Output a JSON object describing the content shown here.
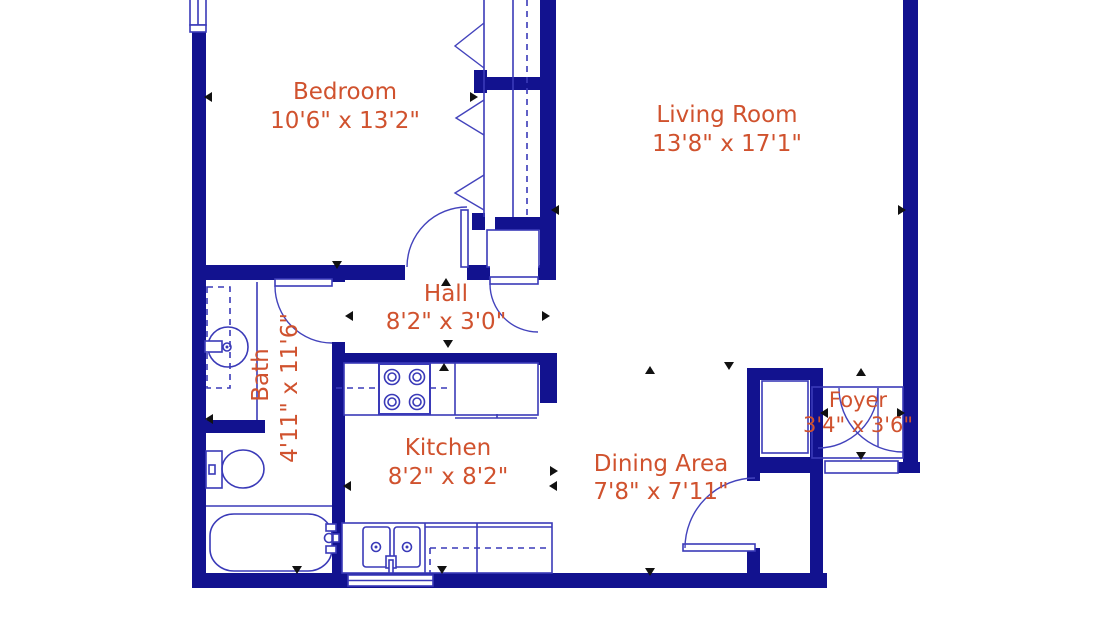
{
  "title": "Apartment floor plan",
  "colors": {
    "wall": "#12128F",
    "line": "#3A3AB8",
    "label_text": "#D0522E",
    "dimension_marker": "#111111",
    "background": "#FFFFFF"
  },
  "rooms": {
    "bedroom": {
      "name": "Bedroom",
      "dimensions": "10'6\" x 13'2\""
    },
    "living_room": {
      "name": "Living Room",
      "dimensions": "13'8\" x 17'1\""
    },
    "hall": {
      "name": "Hall",
      "dimensions": "8'2\" x 3'0\""
    },
    "bath": {
      "name": "Bath",
      "dimensions": "4'11\" x 11'6\""
    },
    "kitchen": {
      "name": "Kitchen",
      "dimensions": "8'2\" x 8'2\""
    },
    "dining_area": {
      "name": "Dining Area",
      "dimensions": "7'8\" x 7'11\""
    },
    "foyer": {
      "name": "Foyer",
      "dimensions": "3'4\" x 3'6\""
    }
  },
  "icons": {
    "bathtub": "rounded-rect-tub-with-faucet",
    "toilet": "tank-and-oval-bowl",
    "vanity_sink": "round-basin-with-faucet",
    "stove": "four-burner-cooktop",
    "kitchen_sink": "double-basin-sink",
    "closet_rod": "dashed-line",
    "bifold_doors": "zigzag-chevrons",
    "door_swings": "quarter-circle-arcs",
    "windows": "double-line-wall-openings"
  }
}
